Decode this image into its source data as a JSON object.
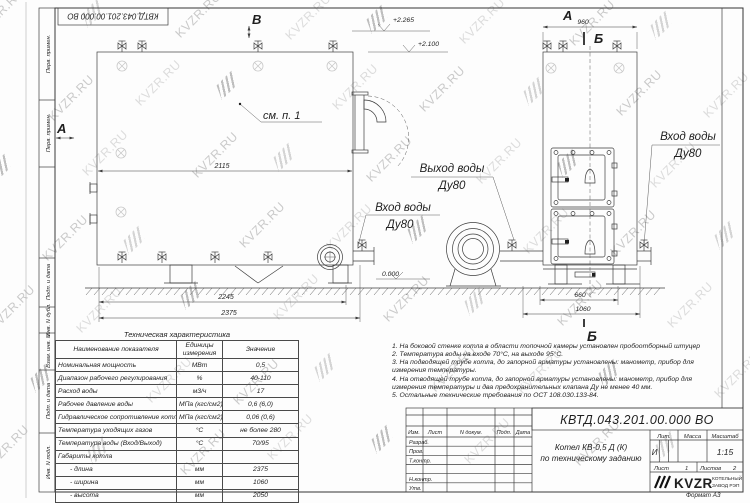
{
  "watermark": {
    "text": "KVZR.RU"
  },
  "frame": {
    "stamp_top": "КВТД.043.201.00.000 ВО",
    "margin_boxes": [
      "Перв. примен.",
      "Перв. примен.",
      "Подп. и дата",
      "Инв. N дубл.",
      "Взам. инв. N",
      "Подп. и дата",
      "Инв. N подл."
    ],
    "format_note": "Формат А3"
  },
  "drawing": {
    "view_b": "В",
    "view_a_left": "А",
    "see_item": "см. п. 1",
    "dim_2115": "2115",
    "dim_2245": "2245",
    "dim_2375": "2375",
    "elev_top": "+2.265",
    "elev_mid": "+2.100",
    "elev_zero": "0.000",
    "out_water_1": "Выход воды",
    "out_water_2": "Ду80",
    "in_water_1": "Вход воды",
    "in_water_2": "Ду80",
    "side_view_a": "А",
    "dim_960": "960",
    "sec_b_top": "Б",
    "sec_b_bottom": "Б",
    "dim_660": "660",
    "dim_1060": "1060",
    "in_water_side_1": "Вход воды",
    "in_water_side_2": "Ду80"
  },
  "tech_table": {
    "title": "Техническая характеристика",
    "headers": [
      "Наименование показателя",
      "Единицы измерения",
      "Значение"
    ],
    "rows": [
      [
        "Номинальная мощность",
        "МВт",
        "0,5"
      ],
      [
        "Диапазон рабочего регулирования",
        "%",
        "40-110"
      ],
      [
        "Расход воды",
        "м3/ч",
        "17"
      ],
      [
        "Рабочее давление воды",
        "МПа (кгс/см2)",
        "0,6 (6,0)"
      ],
      [
        "Гидравлическое сопротивление котла",
        "МПа (кгс/см2)",
        "0,06 (0,6)"
      ],
      [
        "Температура уходящих газов",
        "°С",
        "не более 280"
      ],
      [
        "Температура воды (Вход/Выход)",
        "°С",
        "70/95"
      ],
      [
        "Габариты котла",
        "",
        ""
      ],
      [
        "- длина",
        "мм",
        "2375"
      ],
      [
        "- ширина",
        "мм",
        "1060"
      ],
      [
        "- высота",
        "мм",
        "2050"
      ]
    ]
  },
  "notes": [
    "1. На боковой стенке котла в области топочной камеры установлен пробоотборный штуцер",
    "2. Температура воды на входе 70°С, на выходе 95°С.",
    "3. На подводящей трубе котла, до запорной арматуры установлены: манометр, прибор для измерения температуры.",
    "4. На отводящей трубе котла, до запорной арматуры установлены: манометр, прибор для измерения температуры и два предохранительных клапана Ду не менее 40 мм.",
    "5. Остальные технические требования по ОСТ 108.030.133-84."
  ],
  "title_block": {
    "doc_number": "КВТД.043.201.00.000  ВО",
    "col_headers": [
      "Изм.",
      "Лист",
      "N докум.",
      "Подп.",
      "Дата"
    ],
    "row_labels": [
      "Разраб.",
      "Пров.",
      "Т.контр.",
      "",
      "Н.контр.",
      "Утв."
    ],
    "product_line1": "Котел  КВ-0,5  Д  (К)",
    "product_line2": "по техническому заданию",
    "lit": "Лит.",
    "mass": "Масса",
    "scale": "Масштаб",
    "lit_value": "И",
    "scale_value": "1:15",
    "sheet_label": "Лист",
    "sheet_value": "1",
    "sheets_label": "Листов",
    "sheets_value": "2",
    "logo": "KVZR",
    "logo_cap1": "КОТЕЛЬНЫЙ",
    "logo_cap2": "ЗАВОД РЭП"
  }
}
